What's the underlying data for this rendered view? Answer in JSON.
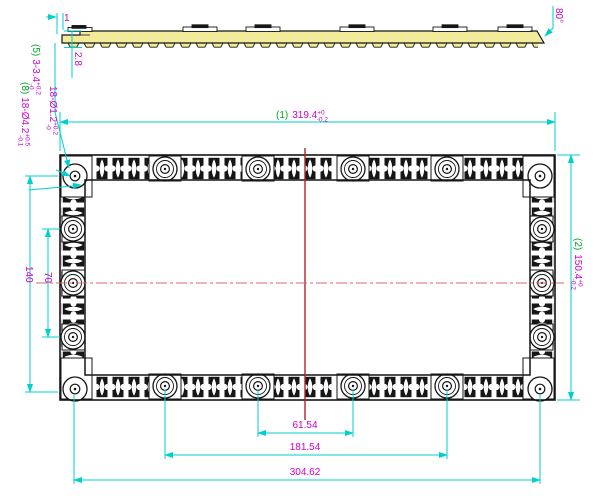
{
  "drawing": {
    "colors": {
      "dimension_line": "#00cfcf",
      "dimension_text": "#cc00cc",
      "reference_text": "#00a51f",
      "centerline": "#c02a2a",
      "section_fill": "#f2ec9a",
      "outline": "#161616"
    },
    "side_view": {
      "thickness_dim": "2.8",
      "end_step_dim": "1",
      "draft_angle_dim": "80°"
    },
    "callouts": {
      "pads": {
        "ref": "(5)",
        "text": "3-3.4",
        "tol_up": "+0.2",
        "tol_dn": "-0"
      },
      "small_holes": {
        "text": "18-Ø1.2",
        "tol_up": "+0.2",
        "tol_dn": "-0"
      },
      "large_holes": {
        "ref": "(8)",
        "text": "18-Ø4.2",
        "tol_up": "+0.5",
        "tol_dn": "-0.1"
      }
    },
    "main_view": {
      "width_dim": {
        "ref": "(1)",
        "value": "319.4",
        "tol_up": "+0",
        "tol_dn": "-0.2"
      },
      "height_dim": {
        "ref": "(2)",
        "value": "150.4",
        "tol_up": "+0",
        "tol_dn": "-0.2"
      },
      "left_dims": {
        "inner": "70",
        "outer": "140"
      },
      "bottom_dims": {
        "inner": "61.54",
        "middle": "181.54",
        "outer": "304.62"
      }
    }
  }
}
